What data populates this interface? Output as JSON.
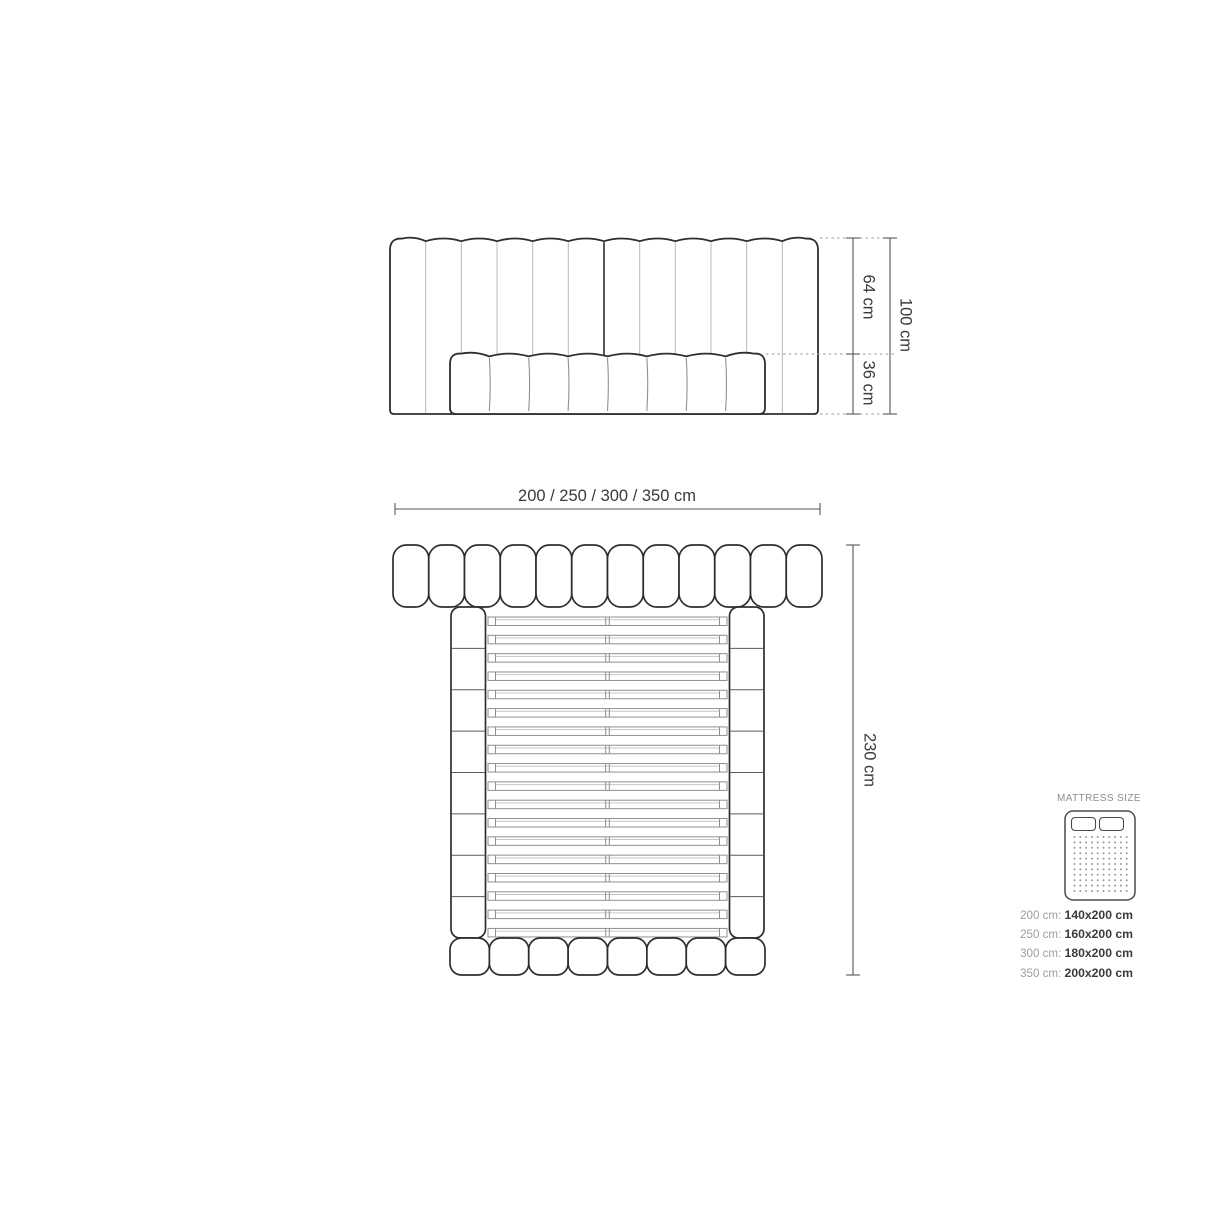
{
  "front_view": {
    "headboard_channels": 12,
    "bed_channels": 8,
    "dim_upper": "64 cm",
    "dim_lower": "36 cm",
    "dim_total": "100 cm"
  },
  "top_view": {
    "dim_width": "200 / 250 / 300 / 350 cm",
    "dim_length": "230 cm",
    "headboard_pills": 12,
    "footboard_pills": 8,
    "slats": 18,
    "rail_segments_per_side": 8
  },
  "mattress_panel": {
    "title": "MATTRESS SIZE",
    "sizes": [
      {
        "frame": "200 cm:",
        "mattress": "140x200 cm"
      },
      {
        "frame": "250 cm:",
        "mattress": "160x200 cm"
      },
      {
        "frame": "300 cm:",
        "mattress": "180x200 cm"
      },
      {
        "frame": "350 cm:",
        "mattress": "200x200 cm"
      }
    ]
  },
  "colors": {
    "line_dark": "#2e2e2e",
    "line_mid": "#8f8f8f",
    "line_light": "#b8b8b8",
    "slat_inner": "#c6c6c6",
    "dim_line": "#555555",
    "dotted": "#9a9a9a",
    "text_dark": "#3a3a3a",
    "text_gray": "#9e9e9e",
    "icon_stroke": "#4a4a4a",
    "icon_dot": "#999999"
  }
}
